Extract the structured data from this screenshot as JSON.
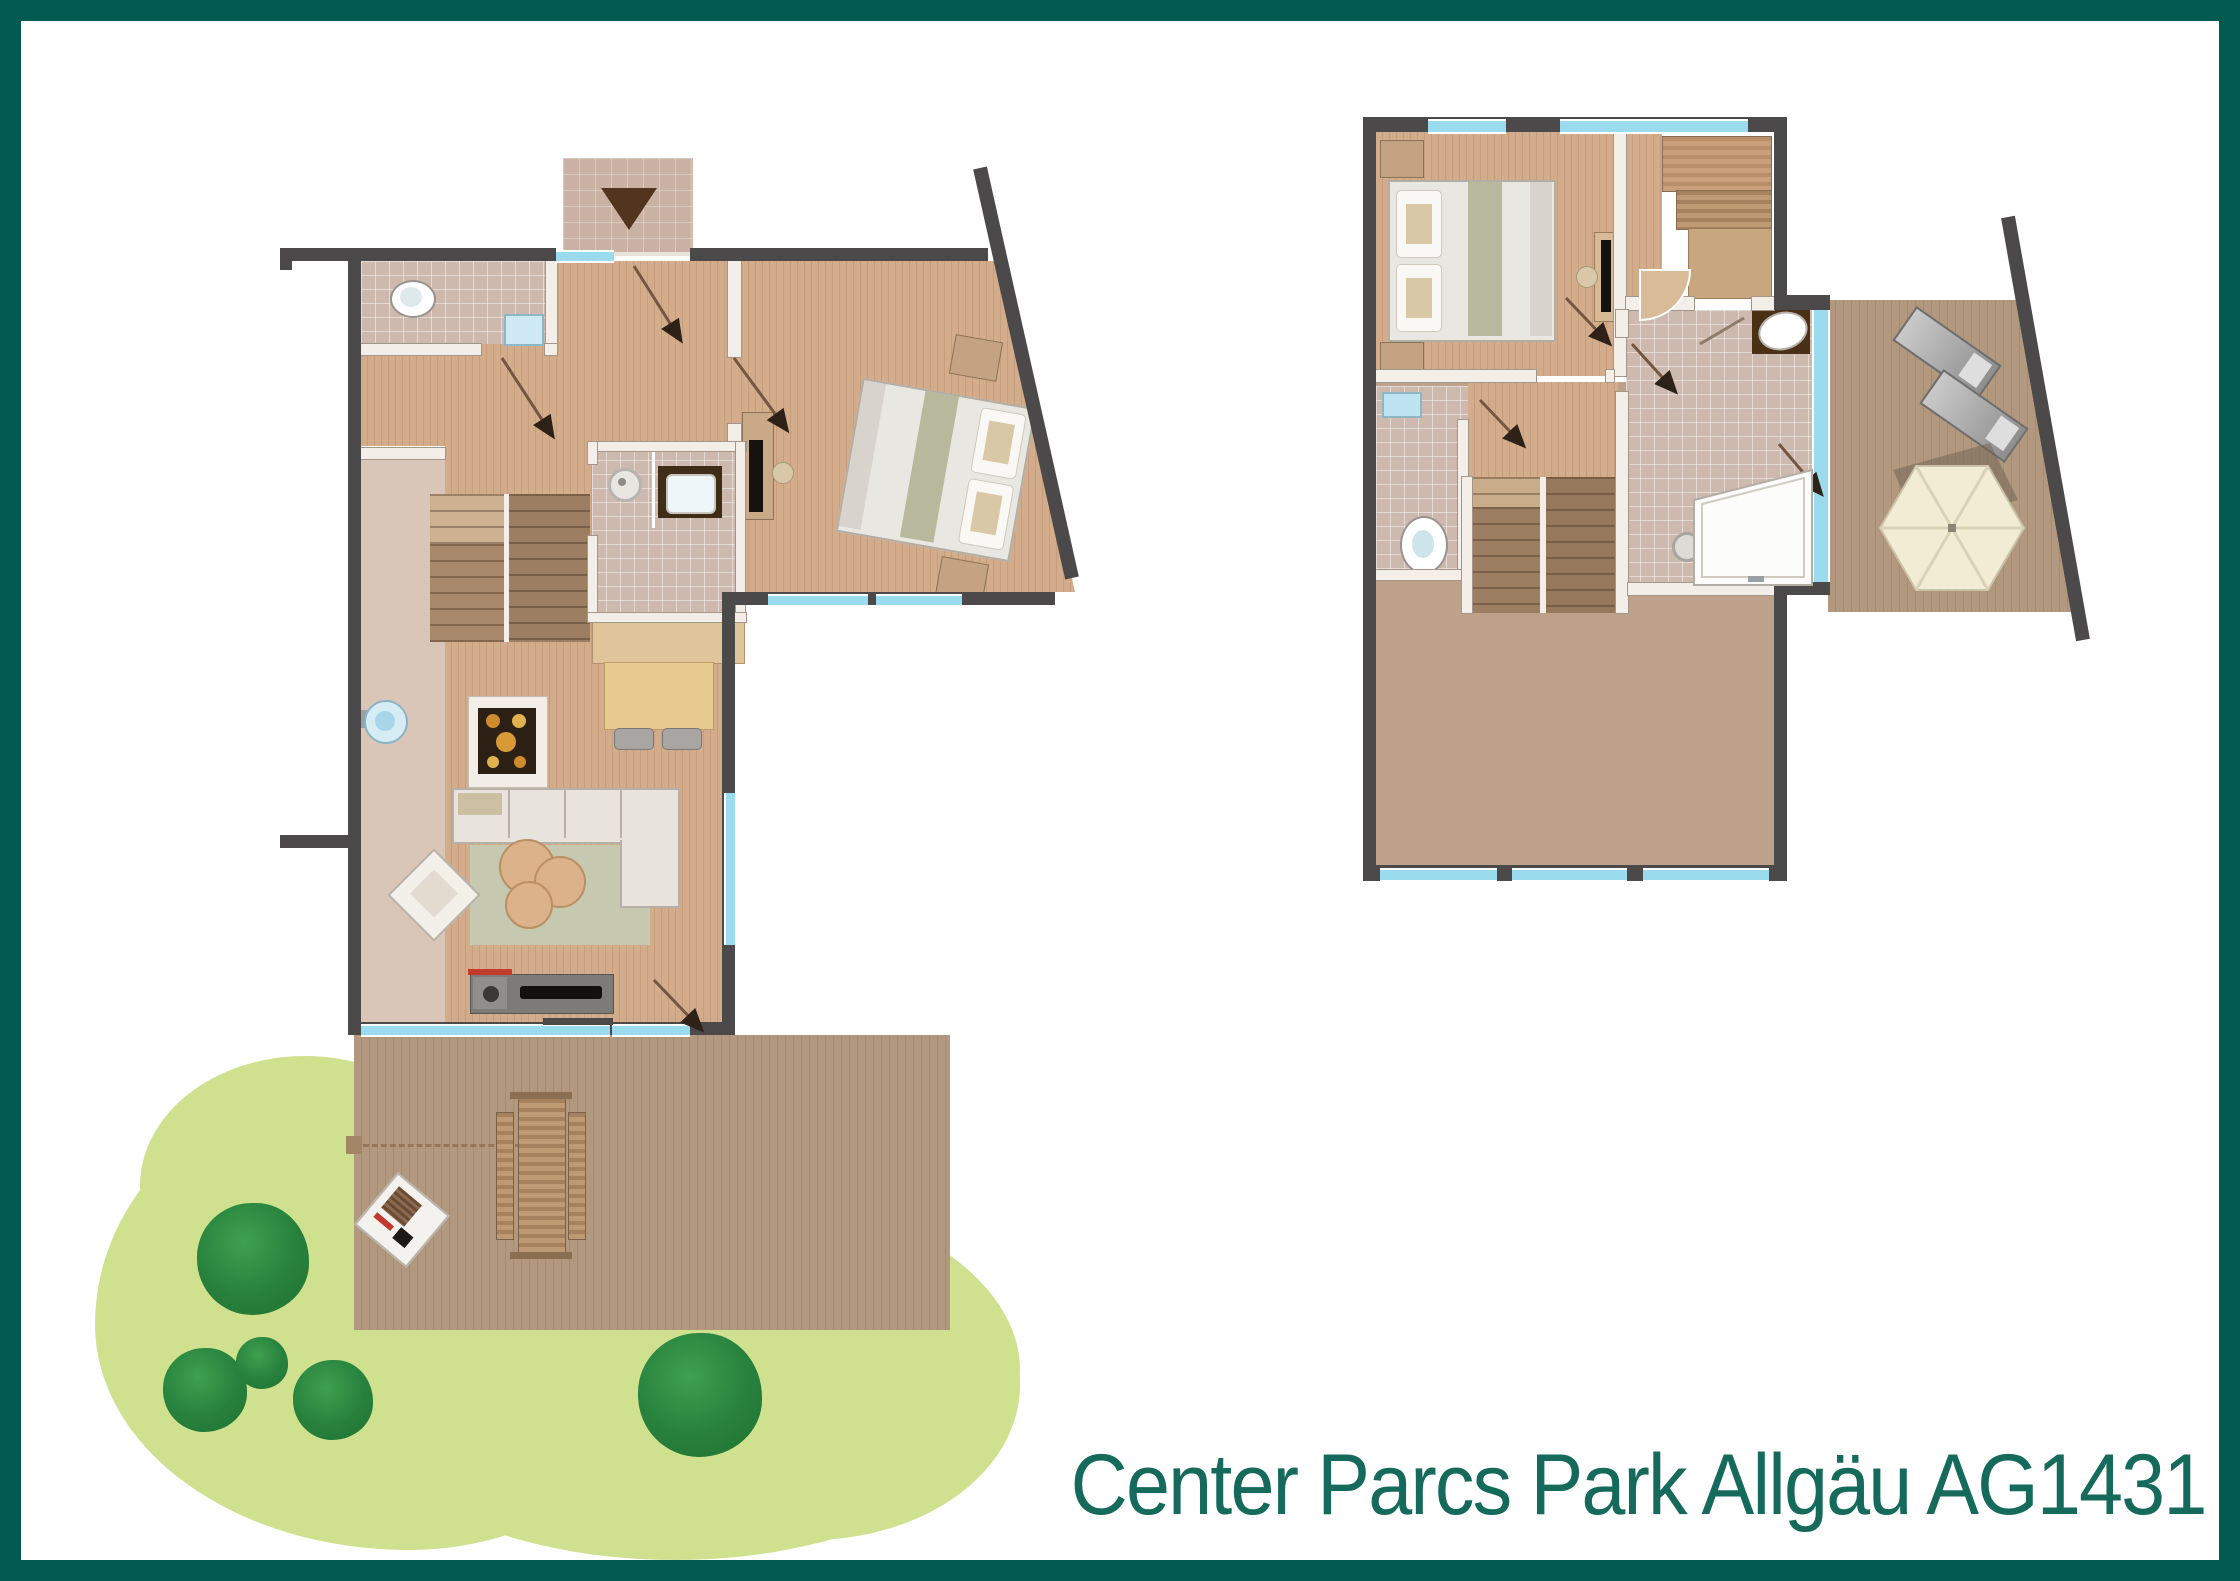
{
  "caption": {
    "text": "Center Parcs Park Allgäu AG1431"
  },
  "palette": {
    "frame": "#015b50",
    "caption": "#156a5c",
    "wall": "#4c494b",
    "window": "#9adcee",
    "wood": "#d2ab8a",
    "tile": "#cdb9ae",
    "deck": "#b2987e",
    "garden": "#cfe18e",
    "bush": "#2a853c",
    "stairs": "#9c7f63"
  },
  "floorplans": [
    {
      "id": "ground-floor",
      "features": [
        "entrance-path",
        "entrance-arrow",
        "front-door",
        "wc",
        "toilet",
        "hand-basin",
        "hallway",
        "staircase",
        "shower-room",
        "shower",
        "washbasin",
        "tv-cabinet",
        "bedroom",
        "double-bed",
        "nightstand",
        "kitchen",
        "cooktop",
        "kitchen-sink",
        "kitchen-counter",
        "dining-table",
        "dining-chairs",
        "living-room",
        "corner-sofa",
        "armchair",
        "rug",
        "coffee-tables",
        "tv-sideboard",
        "sliding-door",
        "windows",
        "terrace",
        "picnic-table",
        "barbecue",
        "garden",
        "bushes"
      ]
    },
    {
      "id": "upper-floor",
      "features": [
        "bedroom",
        "double-bed",
        "nightstand",
        "desk-with-tv",
        "sauna",
        "sauna-benches",
        "bathroom",
        "bathtub",
        "washbasin",
        "separate-wc",
        "toilet",
        "cistern",
        "staircase",
        "landing",
        "glass-wall",
        "balcony",
        "sun-loungers",
        "parasol",
        "roof-area",
        "windows"
      ]
    }
  ]
}
